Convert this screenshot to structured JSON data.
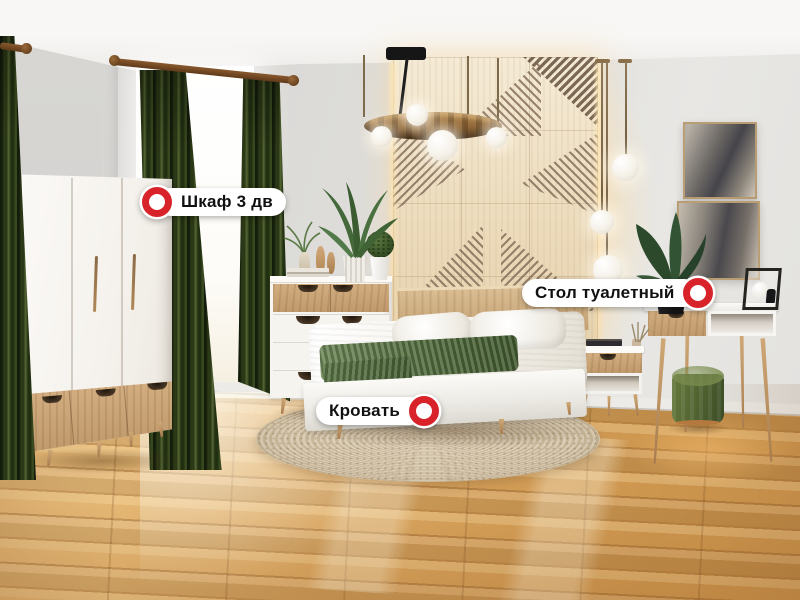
{
  "hotspots": [
    {
      "id": "wardrobe",
      "label": "Шкаф 3 дв",
      "marker_position": "left"
    },
    {
      "id": "dressing-table",
      "label": "Стол туалетный",
      "marker_position": "right"
    },
    {
      "id": "bed",
      "label": "Кровать",
      "marker_position": "right"
    }
  ],
  "marker_style": {
    "ring_color": "#d8232a",
    "fill_color": "#ffffff",
    "label_background": "#ffffff",
    "label_text_color": "#111111"
  },
  "scene_palette": {
    "curtain_green": "#2b3816",
    "floor_wood": "#d9a55f",
    "accent_panel_wood": "#eddcbd",
    "oak_accent": "#c9a478",
    "blanket_green": "#55703f",
    "pouf_green": "#4e6130"
  }
}
